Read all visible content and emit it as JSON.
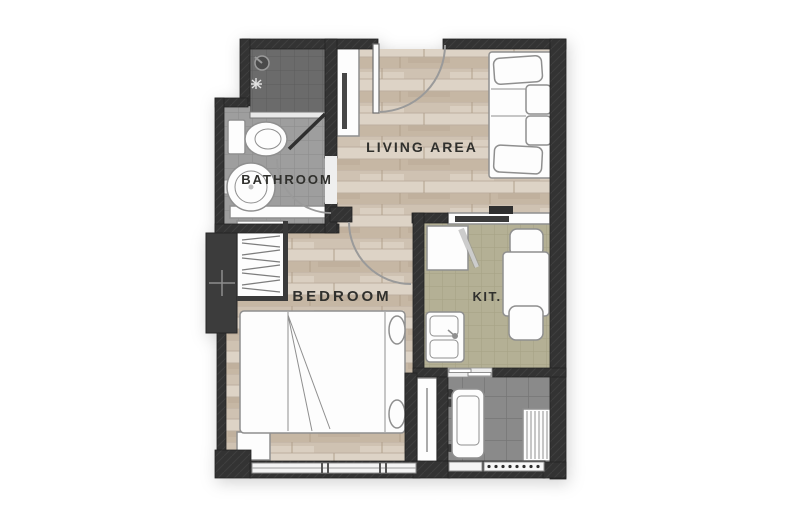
{
  "plan": {
    "labels": {
      "living": "LIVING AREA",
      "bathroom": "BATHROOM",
      "bedroom": "BEDROOM",
      "kitchen": "KIT."
    },
    "colors": {
      "background": "#ffffff",
      "wall": "#333333",
      "shaft": "#3c3c3c",
      "wood": "#d7ccbf",
      "bathroom_tile": "#9e9e9e",
      "shower_tile": "#6b6b6b",
      "kitchen_tile": "#b4b095",
      "balcony_tile": "#8a8a8a",
      "furniture_fill": "#fdfdfd",
      "furniture_outline": "#8f8f8f",
      "label_text": "#30302d",
      "door_arc": "#9a9a9a",
      "appliance_dark": "#3a3a3a"
    }
  }
}
